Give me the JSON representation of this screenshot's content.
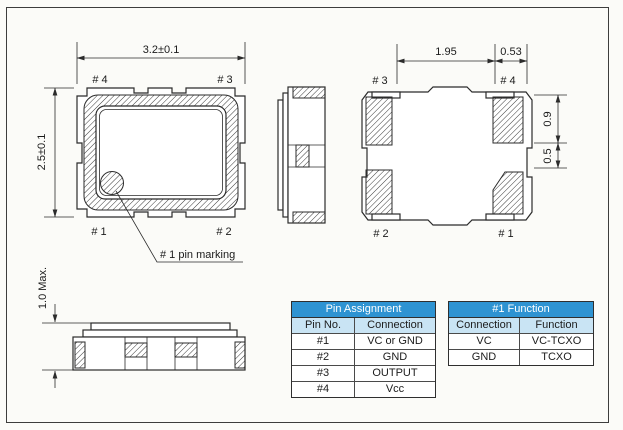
{
  "top_view": {
    "dim_width": "3.2±0.1",
    "dim_height": "2.5±0.1",
    "pin_top_left": "# 4",
    "pin_top_right": "# 3",
    "pin_bottom_left": "# 1",
    "pin_bottom_right": "# 2",
    "marking_note": "# 1 pin marking"
  },
  "bottom_view": {
    "dim_pad_gap": "1.95",
    "dim_pad_width": "0.53",
    "dim_pad_height": "0.9",
    "dim_pad_offset": "0.5",
    "pin_top_left": "# 3",
    "pin_top_right": "# 4",
    "pin_bottom_left": "# 2",
    "pin_bottom_right": "# 1"
  },
  "side_view": {
    "dim_height": "1.0 Max."
  },
  "tables": {
    "pin_assignment": {
      "title": "Pin Assignment",
      "headers": [
        "Pin No.",
        "Connection"
      ],
      "rows": [
        [
          "#1",
          "VC or GND"
        ],
        [
          "#2",
          "GND"
        ],
        [
          "#3",
          "OUTPUT"
        ],
        [
          "#4",
          "Vcc"
        ]
      ]
    },
    "pin1_function": {
      "title": "#1 Function",
      "headers": [
        "Connection",
        "Function"
      ],
      "rows": [
        [
          "VC",
          "VC-TCXO"
        ],
        [
          "GND",
          "TCXO"
        ]
      ]
    }
  },
  "colors": {
    "table_header_bg": "#2e93d2",
    "table_subheader_bg": "#c9e4f4",
    "line": "#2b2b2b",
    "background": "#fbfbf8"
  }
}
